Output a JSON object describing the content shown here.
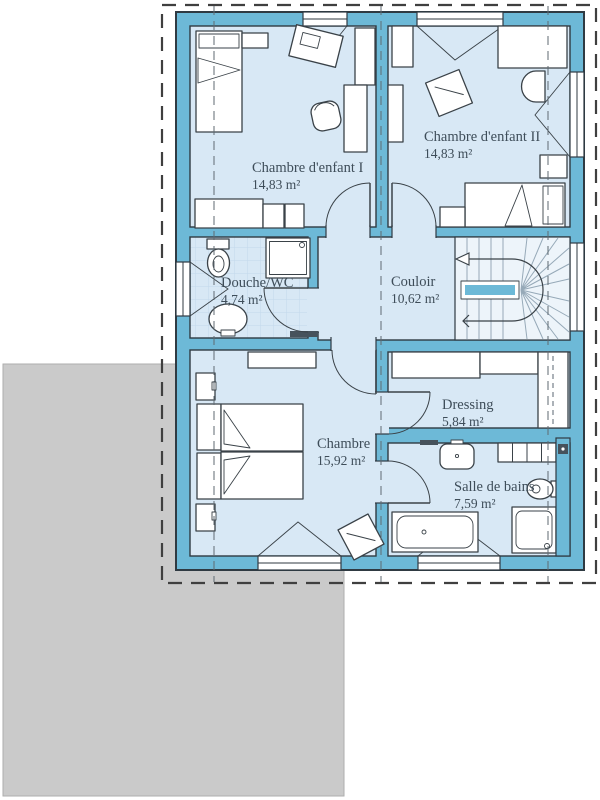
{
  "title": "Floor plan – upper storey",
  "colors": {
    "wall": "#6db9d7",
    "wall_outline": "#2f3a42",
    "floor": "#d8e8f5",
    "floor_light": "#edf4fa",
    "tile_line": "#c2d8eb",
    "furniture_stroke": "#3a4248",
    "ground": "#cacaca",
    "dash_outline": "#3f3f3f",
    "section_line": "#5f6a72",
    "label": "#3e4d59"
  },
  "rooms": [
    {
      "id": "chambre-enfant-1",
      "name": "Chambre d'enfant I",
      "area": "14,83 m²"
    },
    {
      "id": "chambre-enfant-2",
      "name": "Chambre d'enfant II",
      "area": "14,83 m²"
    },
    {
      "id": "douche-wc",
      "name": "Douche/WC",
      "area": "4,74 m²"
    },
    {
      "id": "couloir",
      "name": "Couloir",
      "area": "10,62 m²"
    },
    {
      "id": "dressing",
      "name": "Dressing",
      "area": "5,84 m²"
    },
    {
      "id": "chambre",
      "name": "Chambre",
      "area": "15,92 m²"
    },
    {
      "id": "salle-de-bains",
      "name": "Salle de bains",
      "area": "7,59 m²"
    }
  ]
}
